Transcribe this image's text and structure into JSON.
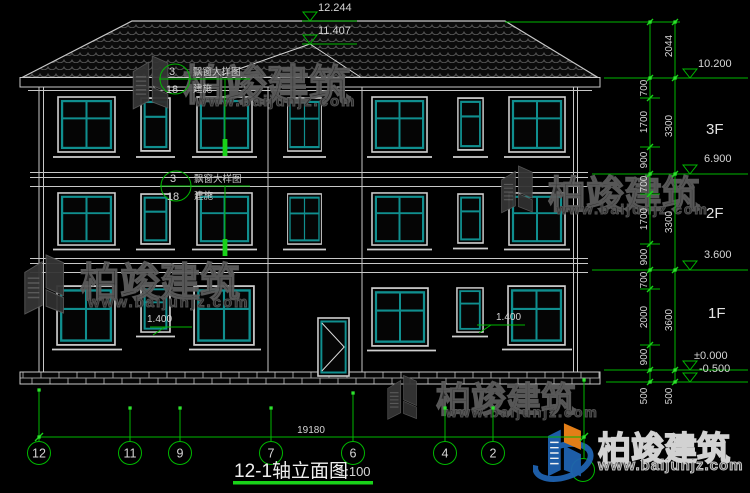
{
  "title": {
    "name": "12-1轴立面图",
    "scale": "1:100"
  },
  "elevations": {
    "ridge": "12.244",
    "gable": "11.407",
    "eave": "10.200",
    "f3": "6.900",
    "f2": "3.600",
    "ground": "±0.000",
    "base": "-0.500"
  },
  "floors": {
    "f3": "3F",
    "f2": "2F",
    "f1": "1F"
  },
  "dims": {
    "overall_width": "19180",
    "right_outer": [
      "2044",
      "3300",
      "3300",
      "3600",
      "500"
    ],
    "right_inner": [
      "700",
      "1700",
      "900",
      "700",
      "1700",
      "900",
      "700",
      "2000",
      "900",
      "500"
    ]
  },
  "axes": [
    "12",
    "11",
    "9",
    "7",
    "6",
    "4",
    "2"
  ],
  "callout": {
    "num": "3",
    "den": "18",
    "line1": "飘窗大样图",
    "line2": "建施"
  },
  "window_sill_height": "1.400",
  "watermark": {
    "brand": "柏竣建筑",
    "url": "www.baijunjz.com"
  },
  "colors": {
    "line": "#c8c8c8",
    "window_frame": "#108f8f",
    "annotation": "#00b800",
    "text": "#d6d6d6",
    "logo_blue": "#1f63b0",
    "logo_orange": "#f08519"
  }
}
